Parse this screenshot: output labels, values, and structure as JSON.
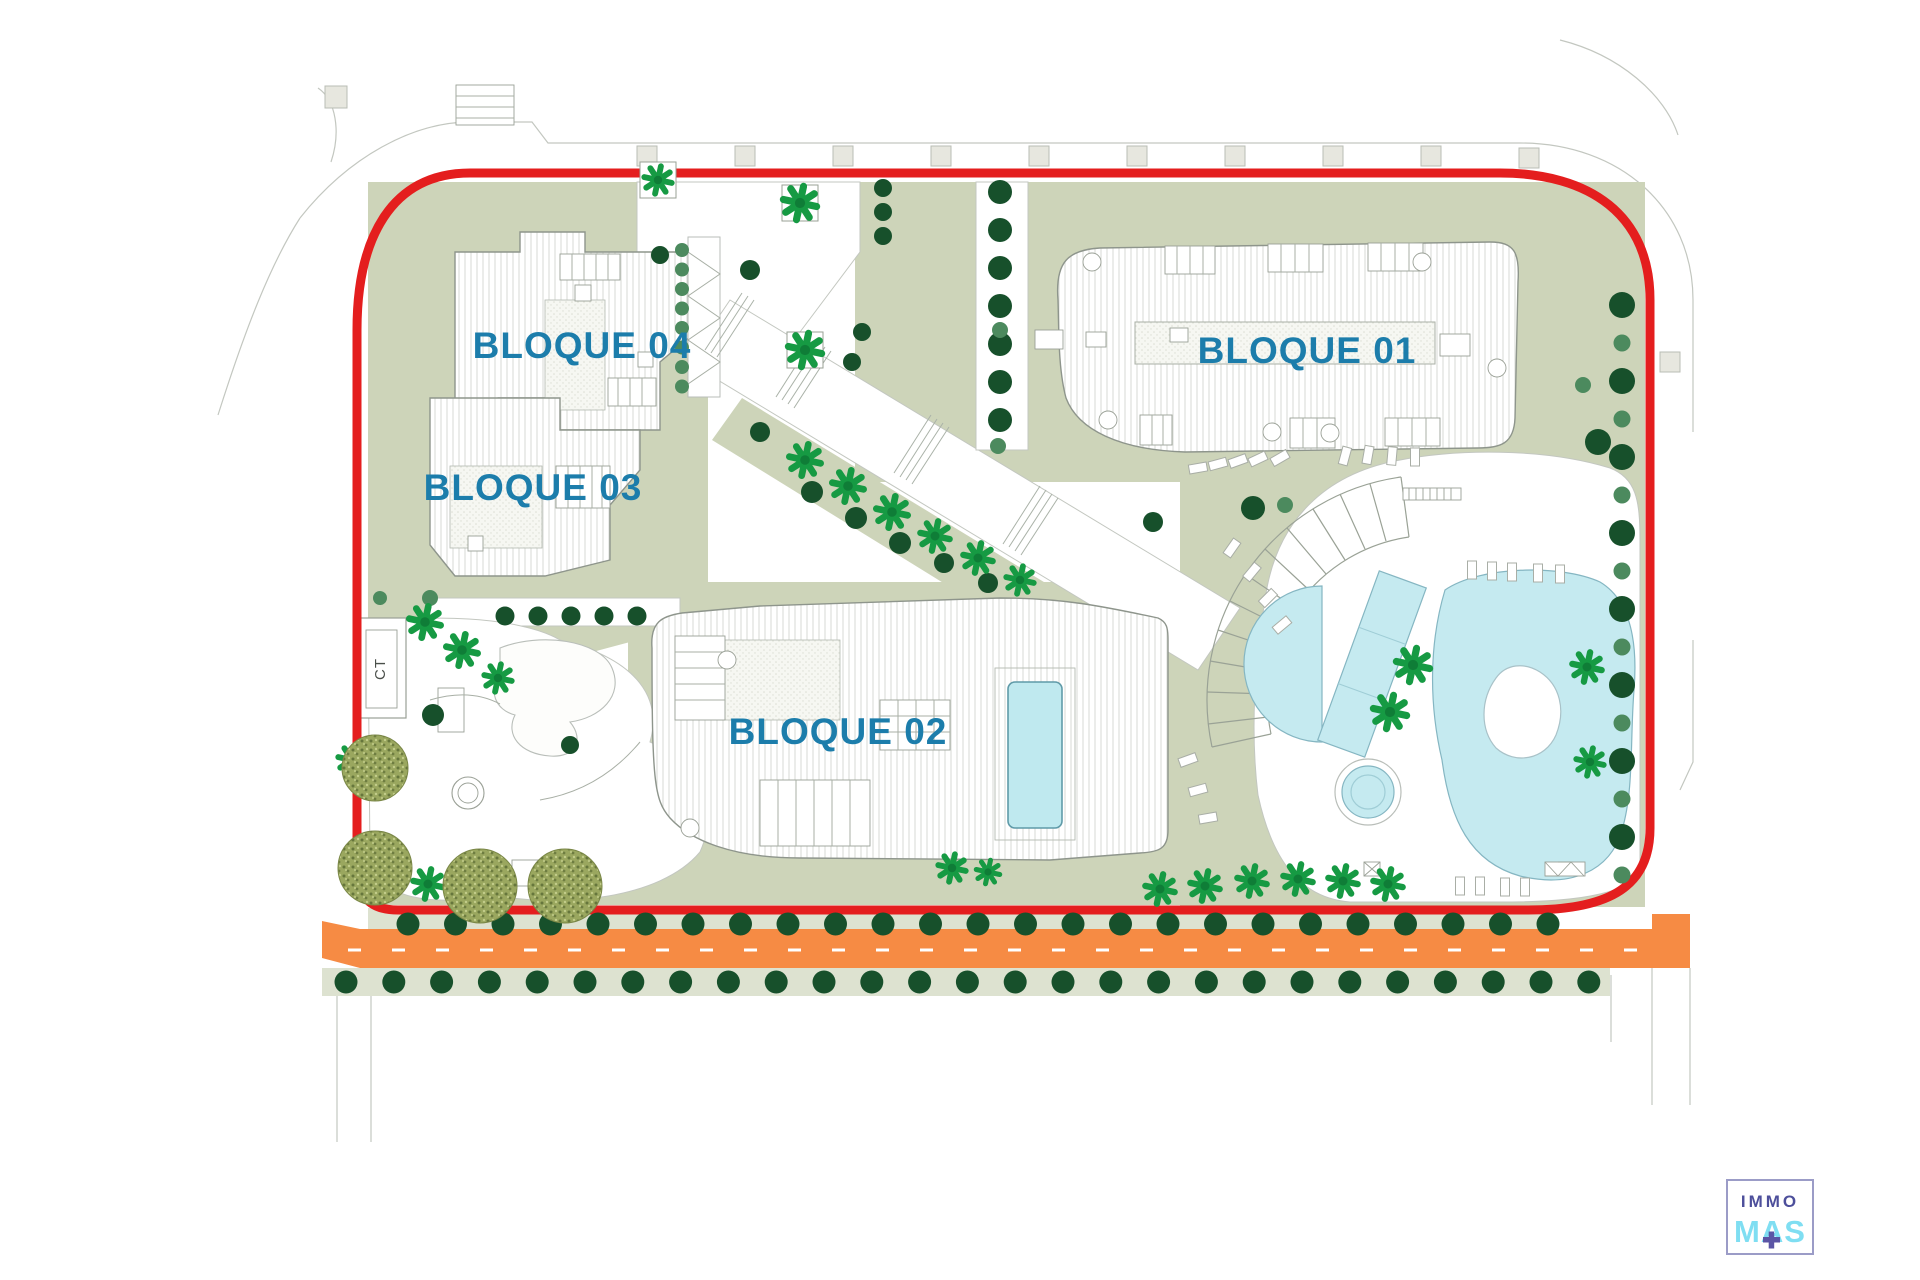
{
  "labels": {
    "b01": "BLOQUE 01",
    "b02": "BLOQUE 02",
    "b03": "BLOQUE 03",
    "b04": "BLOQUE 04",
    "ct": "CT"
  },
  "logo": {
    "line1": "IMMO",
    "line2": "MAS",
    "plus_icon": "plus"
  },
  "colors": {
    "boundary_red": "#e41e1e",
    "road_orange": "#f68b44",
    "label_teal": "#1c7dab",
    "sage": "#cdd4b9",
    "sage_light": "#dde2d0",
    "pool_cyan": "#c5eaf0",
    "pool_edge": "#85b6c2",
    "tree_dark": "#17502b",
    "tree_medium": "#4c8a5e",
    "palm_green": "#169a43",
    "olive": "#9aa75f",
    "logo_purple": "#4d4f9b",
    "logo_cyan": "#7fdef2",
    "logo_plus": "#5b55a5",
    "logo_border": "#9b9cc7"
  },
  "drawing": {
    "tree_rows": [
      {
        "x0": 408,
        "y0": 924,
        "dx": 47.5,
        "dy": 0,
        "n": 25,
        "r": 11.5,
        "c": "tree_dark"
      },
      {
        "x0": 346,
        "y0": 982,
        "dx": 47.8,
        "dy": 0,
        "n": 27,
        "r": 11.5,
        "c": "tree_dark"
      },
      {
        "x0": 1622,
        "y0": 305,
        "dx": 0,
        "dy": 76,
        "n": 8,
        "r": 13,
        "c": "tree_dark"
      },
      {
        "x0": 1622,
        "y0": 343,
        "dx": 0,
        "dy": 76,
        "n": 8,
        "r": 8.5,
        "c": "tree_medium"
      },
      {
        "x0": 1000,
        "y0": 192,
        "dx": 0,
        "dy": 38,
        "n": 7,
        "r": 12,
        "c": "tree_dark"
      },
      {
        "x0": 682,
        "y0": 250,
        "dx": 0,
        "dy": 19.5,
        "n": 8,
        "r": 7,
        "c": "tree_medium"
      },
      {
        "x0": 505,
        "y0": 616,
        "dx": 33,
        "dy": 0,
        "n": 5,
        "r": 9.5,
        "c": "tree_dark"
      },
      {
        "x0": 883,
        "y0": 188,
        "dx": 0,
        "dy": 24,
        "n": 3,
        "r": 9,
        "c": "tree_dark"
      }
    ],
    "tree_singles": [
      [
        812,
        492,
        11,
        "tree_dark"
      ],
      [
        856,
        518,
        11,
        "tree_dark"
      ],
      [
        900,
        543,
        11,
        "tree_dark"
      ],
      [
        944,
        563,
        10,
        "tree_dark"
      ],
      [
        988,
        583,
        10,
        "tree_dark"
      ],
      [
        760,
        432,
        10,
        "tree_dark"
      ],
      [
        750,
        270,
        10,
        "tree_dark"
      ],
      [
        862,
        332,
        9,
        "tree_dark"
      ],
      [
        852,
        362,
        9,
        "tree_dark"
      ],
      [
        1000,
        330,
        8,
        "tree_medium"
      ],
      [
        998,
        446,
        8,
        "tree_medium"
      ],
      [
        1153,
        522,
        10,
        "tree_dark"
      ],
      [
        1253,
        508,
        12,
        "tree_dark"
      ],
      [
        1285,
        505,
        8,
        "tree_medium"
      ],
      [
        1583,
        385,
        8,
        "tree_medium"
      ],
      [
        1598,
        442,
        13,
        "tree_dark"
      ],
      [
        430,
        598,
        8,
        "tree_medium"
      ],
      [
        380,
        598,
        7,
        "tree_medium"
      ],
      [
        433,
        715,
        11,
        "tree_dark"
      ],
      [
        570,
        745,
        9,
        "tree_dark"
      ],
      [
        660,
        255,
        9,
        "tree_dark"
      ]
    ],
    "palms": [
      [
        800,
        203,
        17
      ],
      [
        805,
        350,
        17
      ],
      [
        658,
        180,
        14
      ],
      [
        805,
        460,
        16
      ],
      [
        848,
        486,
        16
      ],
      [
        892,
        512,
        16
      ],
      [
        935,
        536,
        15
      ],
      [
        978,
        558,
        15
      ],
      [
        1020,
        580,
        14
      ],
      [
        1413,
        665,
        17
      ],
      [
        1390,
        712,
        17
      ],
      [
        1587,
        667,
        15
      ],
      [
        1590,
        762,
        14
      ],
      [
        1160,
        889,
        15
      ],
      [
        1205,
        886,
        15
      ],
      [
        1252,
        881,
        15
      ],
      [
        1298,
        879,
        15
      ],
      [
        1343,
        881,
        15
      ],
      [
        1388,
        884,
        15
      ],
      [
        425,
        622,
        16
      ],
      [
        462,
        650,
        16
      ],
      [
        498,
        678,
        14
      ],
      [
        352,
        760,
        14
      ],
      [
        428,
        884,
        15
      ],
      [
        952,
        868,
        14
      ],
      [
        988,
        872,
        12
      ]
    ],
    "olives": [
      [
        375,
        868,
        37
      ],
      [
        480,
        886,
        37
      ],
      [
        565,
        886,
        37
      ],
      [
        375,
        768,
        33
      ]
    ],
    "planters": [
      [
        782,
        185
      ],
      [
        787,
        332
      ],
      [
        640,
        162
      ]
    ],
    "loungers": [
      [
        1198,
        468,
        80
      ],
      [
        1218,
        464,
        75
      ],
      [
        1238,
        461,
        70
      ],
      [
        1258,
        459,
        65
      ],
      [
        1280,
        458,
        60
      ],
      [
        1345,
        456,
        15
      ],
      [
        1368,
        455,
        10
      ],
      [
        1392,
        456,
        5
      ],
      [
        1415,
        457,
        0
      ],
      [
        1472,
        570,
        0
      ],
      [
        1492,
        571,
        0
      ],
      [
        1512,
        572,
        0
      ],
      [
        1538,
        573,
        0
      ],
      [
        1560,
        574,
        0
      ],
      [
        1232,
        548,
        35
      ],
      [
        1252,
        572,
        40
      ],
      [
        1268,
        598,
        45
      ],
      [
        1282,
        625,
        50
      ],
      [
        1188,
        760,
        70
      ],
      [
        1198,
        790,
        75
      ],
      [
        1208,
        818,
        80
      ],
      [
        1460,
        886,
        0
      ],
      [
        1480,
        886,
        0
      ],
      [
        1505,
        887,
        0
      ],
      [
        1525,
        887,
        0
      ]
    ]
  }
}
